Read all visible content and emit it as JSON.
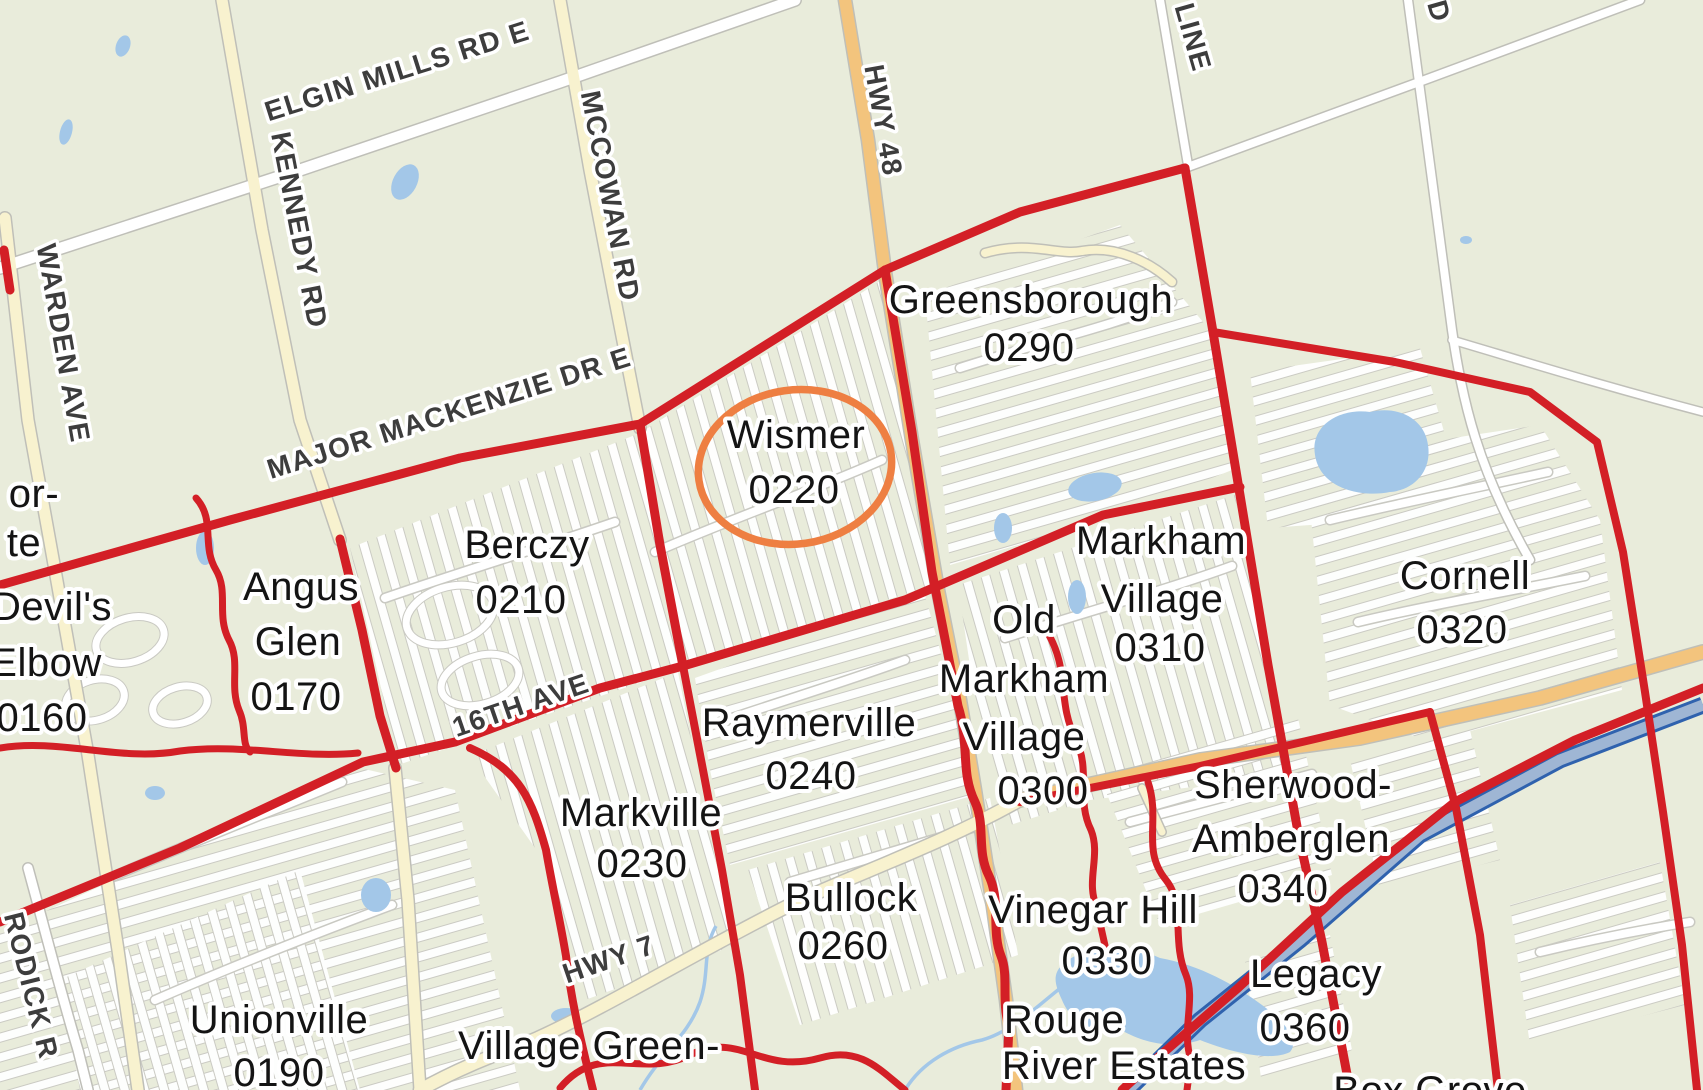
{
  "map": {
    "title": "Markham neighbourhoods map with Wismer 0220 highlighted",
    "colors": {
      "background": "#e9ecdb",
      "boundary_red": "#d31f26",
      "highlight_orange": "#ee7f42",
      "water_blue": "#a3c7e8",
      "road_white": "#ffffff",
      "road_yellow": "#f8f2cf",
      "road_orange": "#f3c47d",
      "toll_highway_blue": "#2f62ae",
      "road_label_gray": "#3d3d3d",
      "neighborhood_label_black": "#141414"
    },
    "highlight_ellipse": {
      "neighborhood": "Wismer",
      "code": "0220",
      "color": "#ee7f42"
    },
    "road_labels": [
      {
        "name": "elgin-mills-rd-e",
        "text": "ELGIN MILLS RD E",
        "x": 400,
        "y": 80,
        "rot": -17.5
      },
      {
        "name": "mccowan-rd",
        "text": "MCCOWAN RD",
        "x": 601,
        "y": 198,
        "rot": 79
      },
      {
        "name": "hwy-48",
        "text": "HWY 48",
        "x": 874,
        "y": 122,
        "rot": 80
      },
      {
        "name": "kennedy-rd",
        "text": "KENNEDY RD",
        "x": 290,
        "y": 232,
        "rot": 79
      },
      {
        "name": "warden-ave",
        "text": "WARDEN AVE",
        "x": 54,
        "y": 345,
        "rot": 80
      },
      {
        "name": "line-partial",
        "text": "LINE",
        "x": 1184,
        "y": 40,
        "rot": 74
      },
      {
        "name": "rd-partial",
        "text": "D",
        "x": 1430,
        "y": 14,
        "rot": 74
      },
      {
        "name": "major-mackenzie-dr-e",
        "text": "MAJOR MACKENZIE DR E",
        "x": 452,
        "y": 422,
        "rot": -17.5
      },
      {
        "name": "16th-ave",
        "text": "16TH AVE",
        "x": 524,
        "y": 714,
        "rot": -19
      },
      {
        "name": "hwy-7",
        "text": "HWY 7",
        "x": 612,
        "y": 968,
        "rot": -19
      },
      {
        "name": "rodick-rd-partial",
        "text": "RODICK R",
        "x": 22,
        "y": 988,
        "rot": 76
      }
    ],
    "neighborhood_labels": [
      {
        "name": "west-partial",
        "lines": [
          {
            "text": "or-",
            "x": 34,
            "y": 507
          },
          {
            "text": "te",
            "x": 24,
            "y": 556
          }
        ]
      },
      {
        "name": "devils-elbow",
        "lines": [
          {
            "text": "Devil's",
            "x": 52,
            "y": 620
          },
          {
            "text": "Elbow",
            "x": 46,
            "y": 676
          },
          {
            "text": "0160",
            "x": 42,
            "y": 731
          }
        ]
      },
      {
        "name": "angus-glen",
        "lines": [
          {
            "text": "Angus",
            "x": 301,
            "y": 600
          },
          {
            "text": "Glen",
            "x": 298,
            "y": 655
          },
          {
            "text": "0170",
            "x": 296,
            "y": 710
          }
        ]
      },
      {
        "name": "berczy",
        "lines": [
          {
            "text": "Berczy",
            "x": 527,
            "y": 558
          },
          {
            "text": "0210",
            "x": 521,
            "y": 613
          }
        ]
      },
      {
        "name": "wismer",
        "lines": [
          {
            "text": "Wismer",
            "x": 796,
            "y": 448
          },
          {
            "text": "0220",
            "x": 794,
            "y": 503
          }
        ]
      },
      {
        "name": "greensborough",
        "lines": [
          {
            "text": "Greensborough",
            "x": 1031,
            "y": 313
          },
          {
            "text": "0290",
            "x": 1029,
            "y": 361
          }
        ]
      },
      {
        "name": "markham-village",
        "lines": [
          {
            "text": "Markham",
            "x": 1161,
            "y": 554
          },
          {
            "text": "Village",
            "x": 1162,
            "y": 612
          },
          {
            "text": "0310",
            "x": 1160,
            "y": 661
          }
        ]
      },
      {
        "name": "old-markham-village",
        "lines": [
          {
            "text": "Old",
            "x": 1024,
            "y": 633
          },
          {
            "text": "Markham",
            "x": 1024,
            "y": 692
          },
          {
            "text": "Village",
            "x": 1024,
            "y": 750
          },
          {
            "text": "0300",
            "x": 1043,
            "y": 804
          }
        ]
      },
      {
        "name": "cornell",
        "lines": [
          {
            "text": "Cornell",
            "x": 1465,
            "y": 589
          },
          {
            "text": "0320",
            "x": 1462,
            "y": 643
          }
        ]
      },
      {
        "name": "raymerville",
        "lines": [
          {
            "text": "Raymerville",
            "x": 809,
            "y": 736
          },
          {
            "text": "0240",
            "x": 811,
            "y": 789
          }
        ]
      },
      {
        "name": "markville",
        "lines": [
          {
            "text": "Markville",
            "x": 641,
            "y": 826
          },
          {
            "text": "0230",
            "x": 642,
            "y": 877
          }
        ]
      },
      {
        "name": "bullock",
        "lines": [
          {
            "text": "Bullock",
            "x": 851,
            "y": 911
          },
          {
            "text": "0260",
            "x": 843,
            "y": 959
          }
        ]
      },
      {
        "name": "sherwood-amberglen",
        "lines": [
          {
            "text": "Sherwood-",
            "x": 1293,
            "y": 798
          },
          {
            "text": "Amberglen",
            "x": 1291,
            "y": 852
          },
          {
            "text": "0340",
            "x": 1283,
            "y": 902
          }
        ]
      },
      {
        "name": "vinegar-hill",
        "lines": [
          {
            "text": "Vinegar Hill",
            "x": 1093,
            "y": 923
          },
          {
            "text": "0330",
            "x": 1107,
            "y": 974
          }
        ]
      },
      {
        "name": "legacy",
        "lines": [
          {
            "text": "Legacy",
            "x": 1316,
            "y": 987
          },
          {
            "text": "0360",
            "x": 1305,
            "y": 1041
          }
        ]
      },
      {
        "name": "rouge-river-estates",
        "lines": [
          {
            "text": "Rouge",
            "x": 1064,
            "y": 1033
          },
          {
            "text": "River Estates",
            "x": 1124,
            "y": 1079
          }
        ]
      },
      {
        "name": "unionville",
        "lines": [
          {
            "text": "Unionville",
            "x": 279,
            "y": 1033
          },
          {
            "text": "0190",
            "x": 279,
            "y": 1086
          }
        ]
      },
      {
        "name": "village-green",
        "lines": [
          {
            "text": "Village Green-",
            "x": 589,
            "y": 1059
          }
        ]
      },
      {
        "name": "box-grove-partial",
        "lines": [
          {
            "text": "Box Grove",
            "x": 1430,
            "y": 1104
          }
        ]
      }
    ]
  }
}
